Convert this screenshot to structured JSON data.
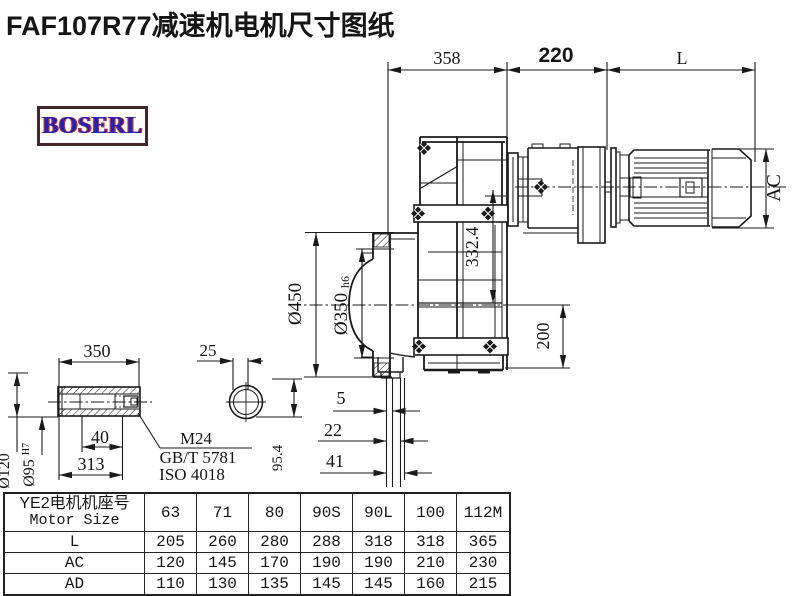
{
  "title": "FAF107R77减速机电机尺寸图纸",
  "logo": {
    "text": "BOSERL"
  },
  "drawing": {
    "dims": {
      "top_left": "358",
      "top_mid": "220",
      "top_right": "L",
      "flange_od": "Ø450",
      "spigot": "Ø350",
      "spigot_tol": "h6",
      "center_dist": "332.4",
      "axis_bottom": "200",
      "motor_ac": "AC",
      "shaft_len": "350",
      "key_width": "25",
      "shaft_od": "Ø120",
      "bore": "Ø95",
      "bore_tol": "H7",
      "step_40": "40",
      "step_313": "313",
      "end_5": "5",
      "end_22": "22",
      "end_41": "41",
      "flat_95_4": "95.4"
    },
    "notes": {
      "thread": "M24",
      "std1": "GB/T 5781",
      "std2": "ISO 4018"
    }
  },
  "table": {
    "header_cn": "YE2电机机座号",
    "header_en": "Motor Size",
    "sizes": [
      "63",
      "71",
      "80",
      "90S",
      "90L",
      "100",
      "112M"
    ],
    "rows": [
      {
        "label": "L",
        "values": [
          "205",
          "260",
          "280",
          "288",
          "318",
          "318",
          "365"
        ]
      },
      {
        "label": "AC",
        "values": [
          "120",
          "145",
          "170",
          "190",
          "190",
          "210",
          "230"
        ]
      },
      {
        "label": "AD",
        "values": [
          "110",
          "130",
          "135",
          "145",
          "145",
          "160",
          "215"
        ]
      }
    ]
  }
}
